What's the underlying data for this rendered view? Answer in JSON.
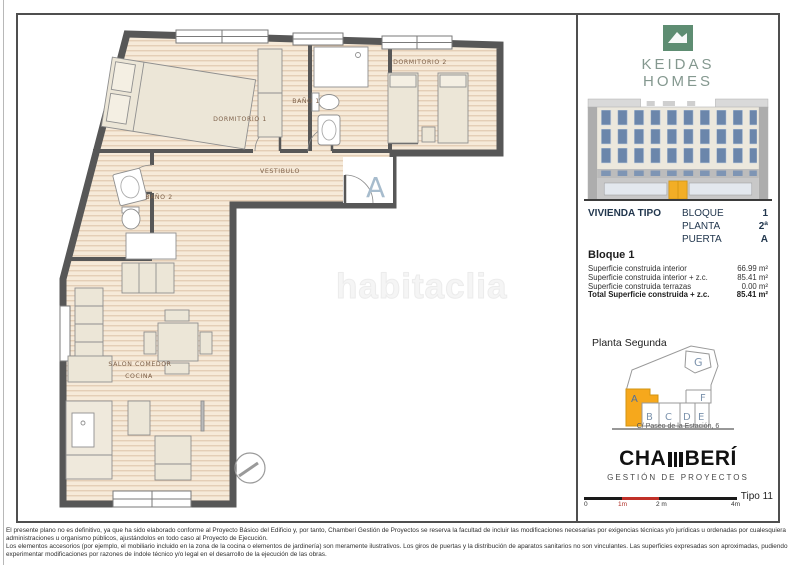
{
  "watermark": "habitaclia",
  "branding": {
    "line1": "KEIDAS",
    "line2": "HOMES"
  },
  "unit_info": {
    "title": "VIVIENDA TIPO",
    "rows": [
      {
        "label": "BLOQUE",
        "value": "1"
      },
      {
        "label": "PLANTA",
        "value": "2ª"
      },
      {
        "label": "PUERTA",
        "value": "A"
      }
    ]
  },
  "surfaces": {
    "heading": "Bloque 1",
    "rows": [
      {
        "label": "Superficie construida interior",
        "value": "66.99 m²"
      },
      {
        "label": "Superficie construida interior + z.c.",
        "value": "85.41 m²"
      },
      {
        "label": "Superficie construida terrazas",
        "value": "0.00 m²"
      }
    ],
    "total": {
      "label": "Total Superficie construida + z.c.",
      "value": "85.41 m²"
    }
  },
  "site_plan": {
    "title": "Planta Segunda",
    "address": "C/ Paseo de la Estación, 6",
    "units": {
      "a": "A",
      "b": "B",
      "c": "C",
      "d": "D",
      "e": "E",
      "f": "F",
      "g": "G"
    },
    "highlighted_unit": "A"
  },
  "developer": {
    "prefix": "CHA",
    "suffix": "BERÍ",
    "subtitle": "GESTIÓN DE PROYECTOS"
  },
  "scale_bar": {
    "labels": [
      "0",
      "1m",
      "2 m",
      "4m"
    ],
    "type_label": "Tipo 11"
  },
  "floor_plan": {
    "rooms": {
      "dormitorio1": "DORMITORIO 1",
      "banio1": "BAÑO 1",
      "dormitorio2": "DORMITORIO 2",
      "vestibulo": "VESTIBULO",
      "banio2": "BAÑO 2",
      "salon": "SALON COMEDOR",
      "cocina": "COCINA"
    },
    "entrance_marker": "A"
  },
  "legal": {
    "p1": "El presente plano no es definitivo, ya que ha sido elaborado conforme al Proyecto Básico del Edificio y, por tanto, Chamberí Gestión de Proyectos se reserva la facultad de incluir las modificaciones necesarias por exigencias técnicas y/o jurídicas u ordenadas por cualesquiera administraciones u organismo públicos, ajustándolos en todo caso al Proyecto de Ejecución.",
    "p2": "Los elementos accesorios (por ejemplo, el mobiliario incluido en la zona de la cocina o elementos de jardinería) son meramente ilustrativos. Los giros de puertas y la distribución de aparatos sanitarios no son vinculantes. Las superficies expresadas son aproximadas, pudiendo experimentar modificaciones por razones de índole técnico y/o legal en el desarrollo de la ejecución de las obras."
  },
  "colors": {
    "brand_green": "#5e8d72",
    "brand_text": "#84988f",
    "accent_yellow": "#f6a81c",
    "scale_red": "#c03028",
    "wall_gray": "#575757",
    "floor_beige": "#f6ead9",
    "window_blue": "#6b86ab",
    "unit_letter_blue": "#7c93ad"
  }
}
